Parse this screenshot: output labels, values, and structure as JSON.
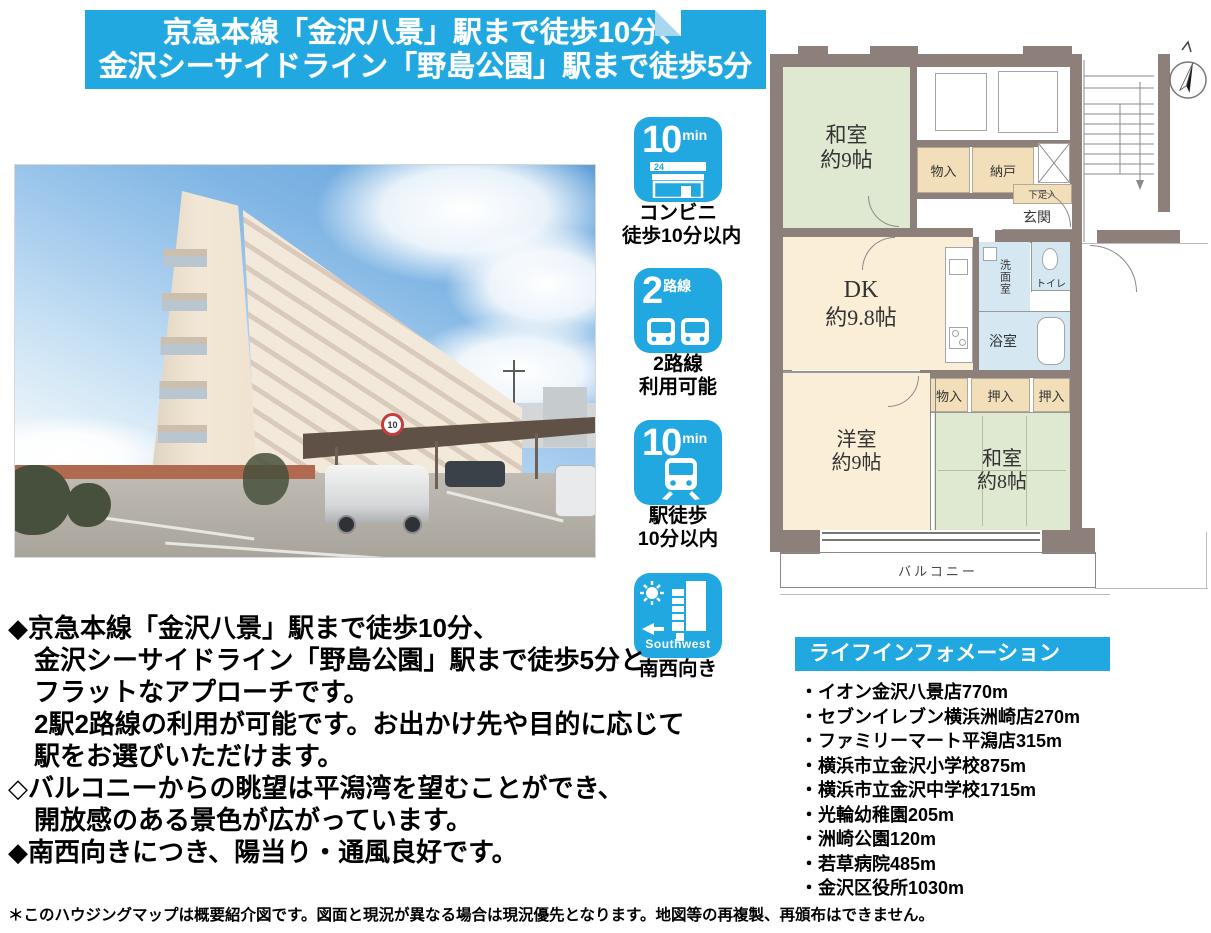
{
  "banner": {
    "line1": "京急本線「金沢八景」駅まで徒歩10分、",
    "line2": "金沢シーサイドライン「野島公園」駅まで徒歩5分"
  },
  "photo": {
    "speed_sign": "10"
  },
  "features": [
    {
      "badge_big": "10",
      "badge_small": "min",
      "sign_text": "24",
      "caption1": "コンビニ",
      "caption2": "徒歩10分以内"
    },
    {
      "badge_big": "2",
      "badge_small": "路線",
      "caption1": "2路線",
      "caption2": "利用可能"
    },
    {
      "badge_big": "10",
      "badge_small": "min",
      "caption1": "駅徒歩",
      "caption2": "10分以内"
    },
    {
      "overlay": "Southwest",
      "caption1": "南西向き"
    }
  ],
  "floorplan": {
    "washitsu9_name": "和室",
    "washitsu9_size": "約9帖",
    "monoire_top": "物入",
    "nando": "納戸",
    "shoebox": "下足入",
    "genkan": "玄関",
    "dk_name": "DK",
    "dk_size": "約9.8帖",
    "senmenshitsu": "洗面室",
    "toire": "トイレ",
    "yokushitsu": "浴室",
    "monoire_mid": "物入",
    "oshiire_left": "押入",
    "oshiire_right": "押入",
    "yoshitsu_name": "洋室",
    "yoshitsu_size": "約9帖",
    "washitsu8_name": "和室",
    "washitsu8_size": "約8帖",
    "balcony": "バルコニー"
  },
  "description": {
    "lines": [
      "◆京急本線「金沢八景」駅まで徒歩10分、",
      "金沢シーサイドライン「野島公園」駅まで徒歩5分と",
      "フラットなアプローチです。",
      "2駅2路線の利用が可能です。お出かけ先や目的に応じて",
      "駅をお選びいただけます。",
      "◇バルコニーからの眺望は平潟湾を望むことができ、",
      "開放感のある景色が広がっています。",
      "◆南西向きにつき、陽当り・通風良好です。"
    ]
  },
  "life_info": {
    "title": "ライフインフォメーション",
    "items": [
      "・イオン金沢八景店770m",
      "・セブンイレブン横浜洲崎店270m",
      "・ファミリーマート平潟店315m",
      "・横浜市立金沢小学校875m",
      "・横浜市立金沢中学校1715m",
      "・光輪幼稚園205m",
      "・洲崎公園120m",
      "・若草病院485m",
      "・金沢区役所1030m"
    ]
  },
  "footnote": "＊このハウジングマップは概要紹介図です。図面と現況が異なる場合は現況優先となります。地図等の再複製、再頒布はできません。",
  "colors": {
    "accent_blue": "#21a8e0",
    "fold_blue": "#a8d8ef",
    "wall": "#8d807b",
    "room_green": "#dfe8d0",
    "room_cream": "#faeed6",
    "room_blue": "#d5e8f2",
    "room_tan": "#f2dfba"
  }
}
